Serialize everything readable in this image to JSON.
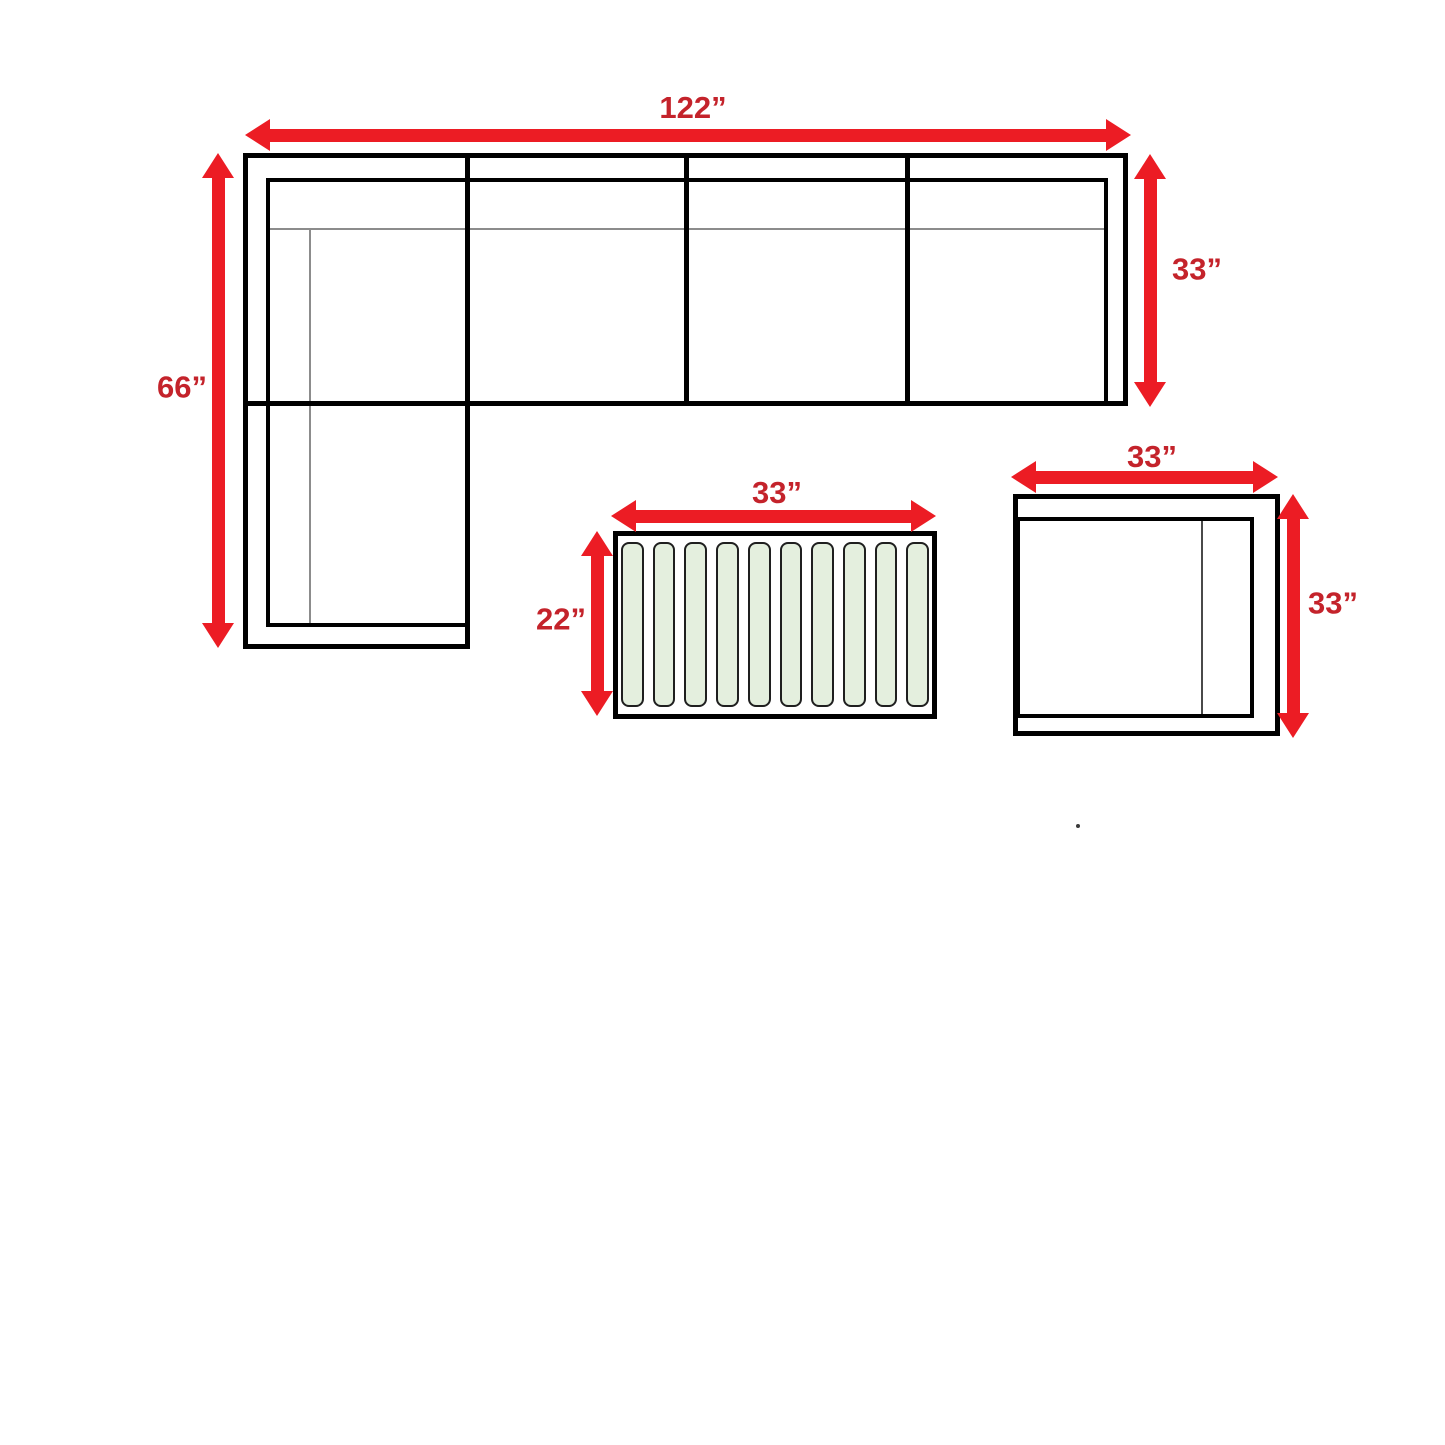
{
  "colors": {
    "arrow": "#ec1c24",
    "label": "#c4232b",
    "line_black": "#000000",
    "line_gray": "#8c8c8c",
    "slat_fill": "#e4efde",
    "slat_border": "#1f1f1f"
  },
  "diagram": {
    "sofa": {
      "name": "sectional-sofa-top-view",
      "width_label": "122”",
      "height_label": "66”",
      "depth_label": "33”",
      "seat_sections": 4
    },
    "coffee_table": {
      "name": "slatted-coffee-table-top-view",
      "width_label": "33”",
      "depth_label": "22”",
      "slat_count": 10
    },
    "chair": {
      "name": "chair-top-view",
      "width_label": "33”",
      "depth_label": "33”"
    }
  }
}
